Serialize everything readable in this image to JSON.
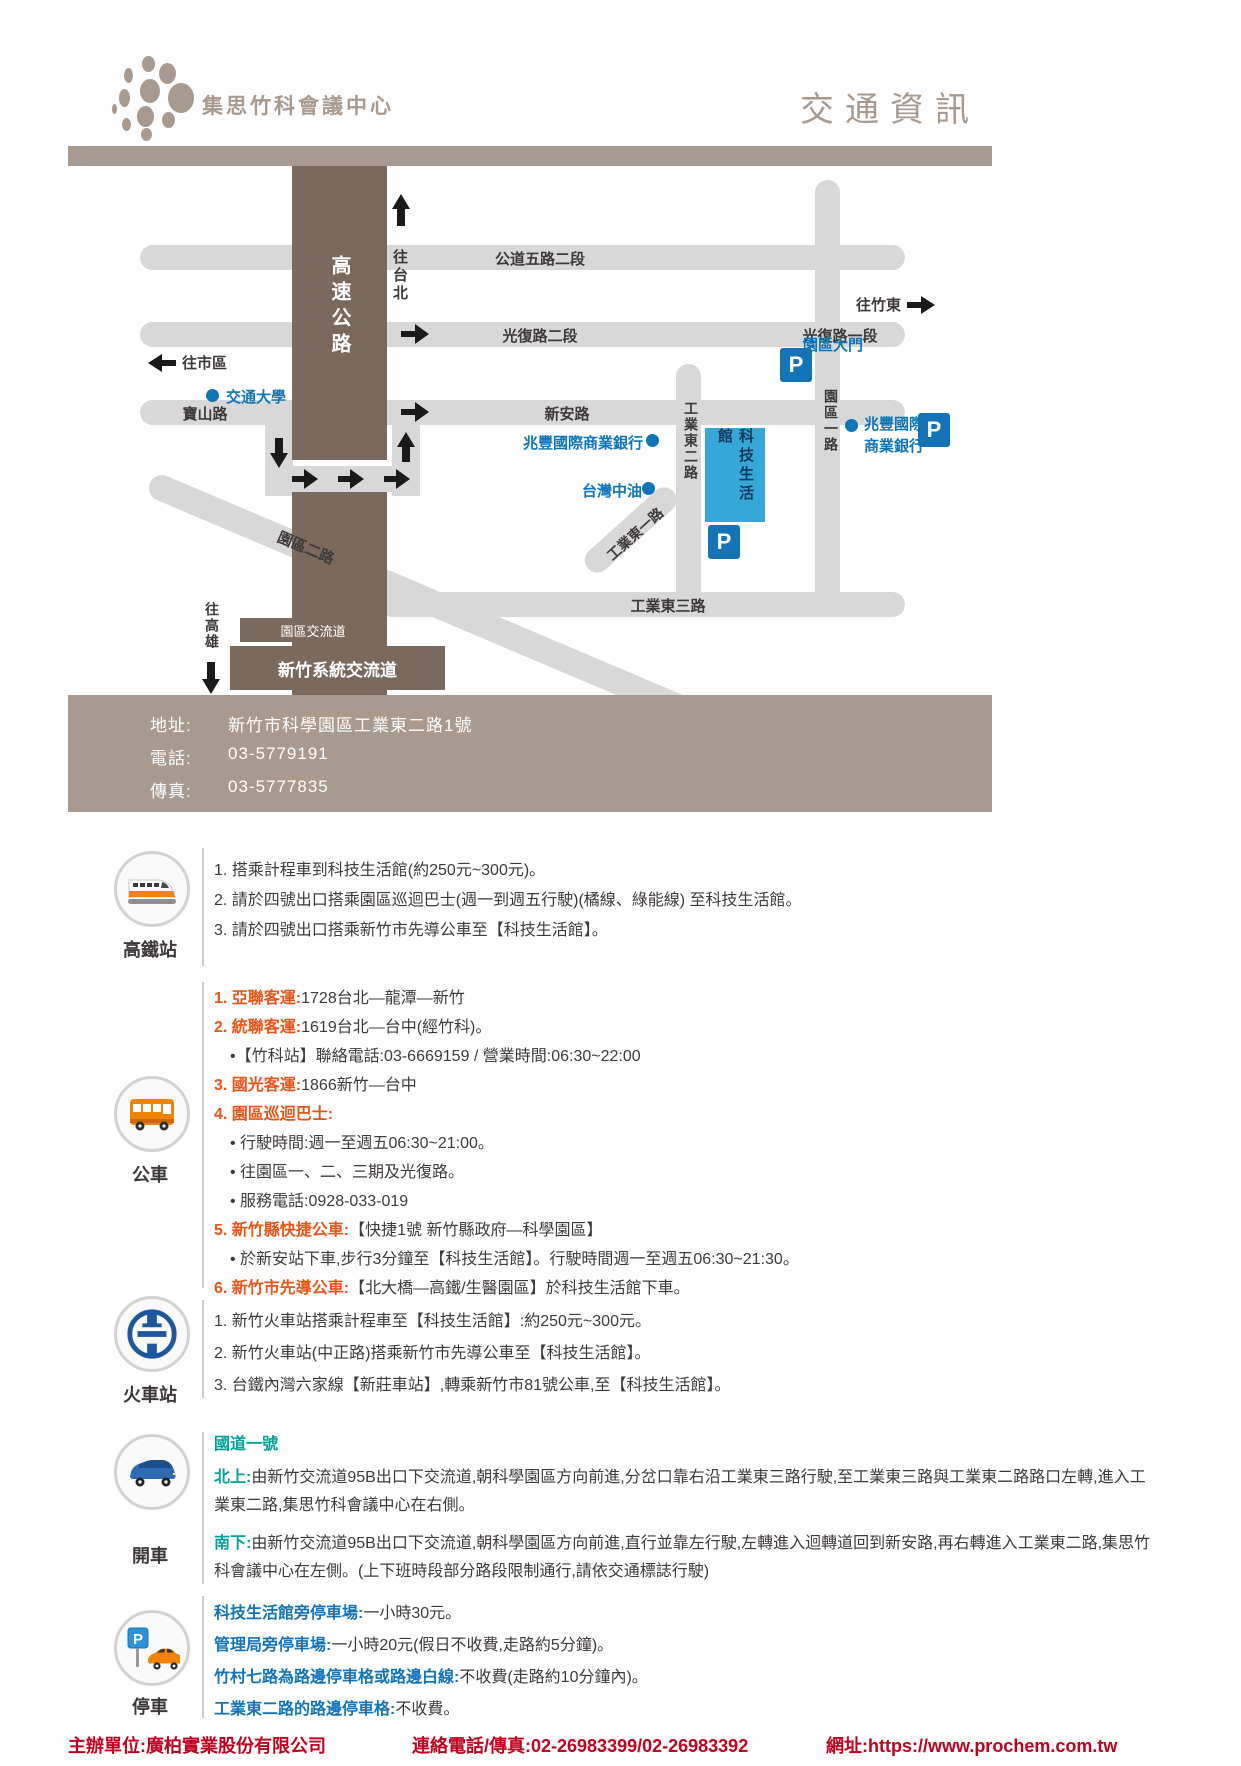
{
  "header": {
    "brand": "集思竹科會議中心",
    "title": "交通資訊"
  },
  "colors": {
    "taupe": "#a89a8e",
    "highway_brown": "#7a695c",
    "road_gray": "#d8d8d8",
    "map_blue": "#0d75ba",
    "building_blue": "#36a7d9",
    "orange": "#ea5414",
    "teal": "#00a29a",
    "parking_blue": "#1274bc",
    "footer_red": "#c3001e"
  },
  "map": {
    "p": "P",
    "roads": {
      "gongdao52": "公道五路二段",
      "guangfu2": "光復路二段",
      "guangfu1": "光復路一段",
      "baoshan": "寶山路",
      "xinan": "新安路",
      "highway": "高速公路",
      "yuanqu1": "園區一路",
      "yuanqu2": "園區二路",
      "gongye1": "工業東一路",
      "gongye2": "工業東二路",
      "gongye3": "工業東三路"
    },
    "dirs": {
      "taipei": "往台北",
      "city": "往市區",
      "zhudong": "往竹東",
      "kaohsiung": "往高雄"
    },
    "places": {
      "nctu": "交通大學",
      "mega": "兆豐國際商業銀行",
      "mega_r1": "兆豐國際",
      "mega_r2": "商業銀行",
      "cpc": "台灣中油",
      "gate": "園區大門",
      "building": "科技生活館",
      "interchange": "園區交流道",
      "system": "新竹系統交流道"
    }
  },
  "contact": {
    "addr_label": "地址:",
    "addr": "新竹市科學園區工業東二路1號",
    "tel_label": "電話:",
    "tel": "03-5779191",
    "fax_label": "傳真:",
    "fax": "03-5777835"
  },
  "hsr": {
    "label": "高鐵站",
    "lines": [
      "1. 搭乘計程車到科技生活館(約250元~300元)。",
      "2. 請於四號出口搭乘園區巡迴巴士(週一到週五行駛)(橘線、綠能線) 至科技生活館。",
      "3. 請於四號出口搭乘新竹市先導公車至【科技生活館】。"
    ]
  },
  "bus": {
    "label": "公車",
    "rows": [
      {
        "h": "1. 亞聯客運:",
        "t": "1728台北—龍潭—新竹"
      },
      {
        "h": "2. 統聯客運:",
        "t": "1619台北—台中(經竹科)。"
      },
      {
        "h": "",
        "t": "•【竹科站】聯絡電話:03-6669159 / 營業時間:06:30~22:00"
      },
      {
        "h": "3. 國光客運:",
        "t": "1866新竹—台中"
      },
      {
        "h": "4. 園區巡迴巴士:",
        "t": ""
      },
      {
        "h": "",
        "t": "• 行駛時間:週一至週五06:30~21:00。"
      },
      {
        "h": "",
        "t": "• 往園區一、二、三期及光復路。"
      },
      {
        "h": "",
        "t": "• 服務電話:0928-033-019"
      },
      {
        "h": "5. 新竹縣快捷公車:",
        "t": "【快捷1號 新竹縣政府—科學園區】"
      },
      {
        "h": "",
        "t": "• 於新安站下車,步行3分鐘至【科技生活館】。行駛時間週一至週五06:30~21:30。"
      },
      {
        "h": "6. 新竹市先導公車:",
        "t": "【北大橋—高鐵/生醫園區】於科技生活館下車。"
      }
    ]
  },
  "train": {
    "label": "火車站",
    "lines": [
      "1. 新竹火車站搭乘計程車至【科技生活館】:約250元~300元。",
      "2. 新竹火車站(中正路)搭乘新竹市先導公車至【科技生活館】。",
      "3. 台鐵內灣六家線【新莊車站】,轉乘新竹市81號公車,至【科技生活館】。"
    ]
  },
  "car": {
    "label": "開車",
    "road": "國道一號",
    "north_h": "北上:",
    "north": "由新竹交流道95B出口下交流道,朝科學園區方向前進,分岔口靠右沿工業東三路行駛,至工業東三路與工業東二路路口左轉,進入工業東二路,集思竹科會議中心在右側。",
    "south_h": "南下:",
    "south": "由新竹交流道95B出口下交流道,朝科學園區方向前進,直行並靠左行駛,左轉進入迴轉道回到新安路,再右轉進入工業東二路,集思竹科會議中心在左側。(上下班時段部分路段限制通行,請依交通標誌行駛)"
  },
  "park": {
    "label": "停車",
    "rows": [
      {
        "h": "科技生活館旁停車場:",
        "t": "一小時30元。"
      },
      {
        "h": "管理局旁停車場:",
        "t": "一小時20元(假日不收費,走路約5分鐘)。"
      },
      {
        "h": "竹村七路為路邊停車格或路邊白線:",
        "t": "不收費(走路約10分鐘內)。"
      },
      {
        "h": "工業東二路的路邊停車格:",
        "t": "不收費。"
      }
    ]
  },
  "footer": {
    "org": "主辦單位:廣柏實業股份有限公司",
    "tel": "連絡電話/傳真:02-26983399/02-26983392",
    "web": "網址:https://www.prochem.com.tw"
  }
}
